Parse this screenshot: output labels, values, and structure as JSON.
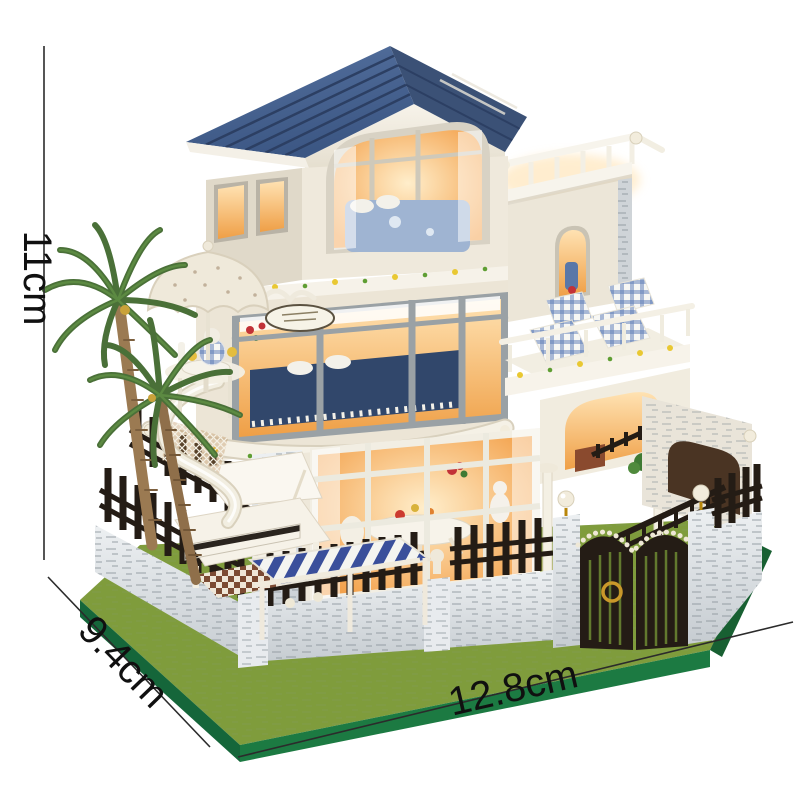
{
  "page": {
    "type": "product-dimension-photo",
    "subject": "DIY miniature dollhouse kit: three-storey villa with blue panelled gable roof, warm-lit interiors, rooftop terrace, curved white balconies, blue gingham deck chairs, palm trees, lace parasol, white grand piano, striped garden awning, stone perimeter wall with black picket fence, pearl lamp posts and arched black gate on a green felt base"
  },
  "dimensions": {
    "height_label": "11cm",
    "depth_label": "9.4cm",
    "width_label": "12.8cm"
  },
  "colors": {
    "background": "#ffffff",
    "dimension_line": "#2b2b2b",
    "label_text": "#101010",
    "roof_blue": "#46618f",
    "roof_blue_dark": "#3b5176",
    "wall_cream": "#efe9dc",
    "window_frame_gray": "#9aa1a5",
    "window_glow": "#f6a94e",
    "stone_gray": "#dfe3e6",
    "fence_black": "#241c15",
    "grass_green": "#7f9c3c",
    "base_green": "#1c7a42",
    "palm_green": "#4a7038",
    "trunk_brown": "#9b7a52",
    "gingham_blue": "#5a7ab5",
    "awning_navy": "#3a4f9b",
    "pearl_white": "#f2ecdc",
    "gold": "#c9982a",
    "bed_navy": "#31476b",
    "vine_green": "#5f9e33",
    "flower_yellow": "#e9c832"
  }
}
